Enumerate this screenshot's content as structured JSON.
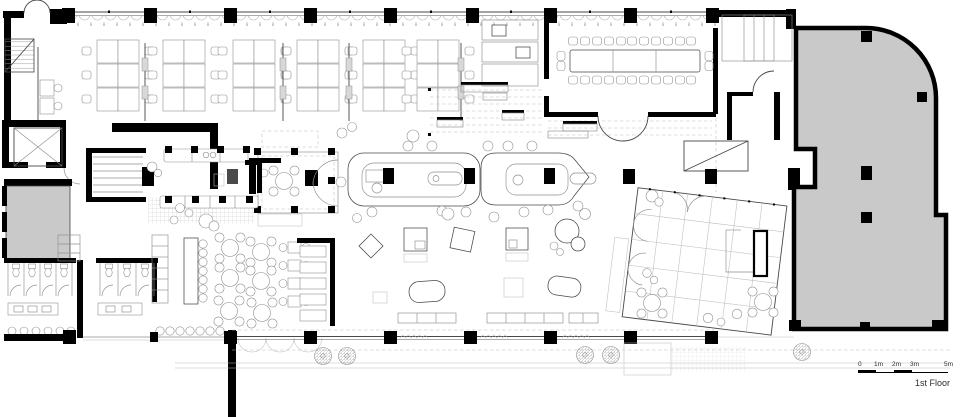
{
  "floor_label": "1st Floor",
  "scale_bar": {
    "labels": [
      "0",
      "1m",
      "2m",
      "3m",
      "5m"
    ]
  },
  "colors": {
    "wall": "#000000",
    "annex_fill": "#c9c9c9",
    "line_dark": "#474747",
    "line_mid": "#8f8f8f",
    "line_light": "#bdbdbd",
    "equipment_dark": "#4a4a4a",
    "text": "#2b2b2b"
  }
}
